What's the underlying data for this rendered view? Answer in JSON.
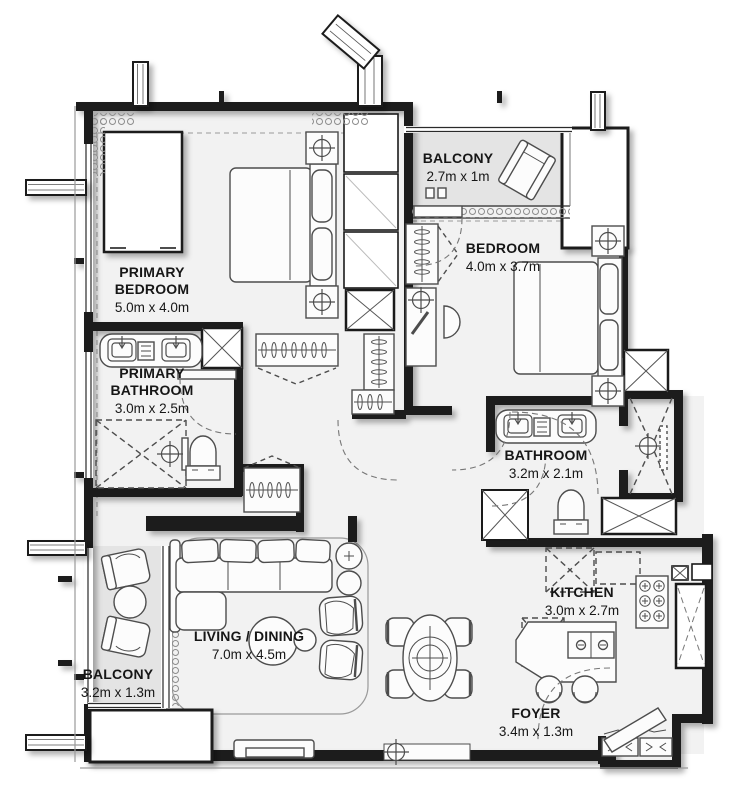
{
  "plan": {
    "type": "apartment-floor-plan",
    "colors": {
      "wall": "#1a1a1a",
      "floor": "#f2f2f2",
      "balcony_floor": "#e4e4e4",
      "furniture_line": "#4d4d4d",
      "text": "#161616",
      "white": "#ffffff"
    },
    "rooms": [
      {
        "id": "primary-bedroom",
        "name": "PRIMARY BEDROOM",
        "dims": "5.0m x 4.0m"
      },
      {
        "id": "balcony-top",
        "name": "BALCONY",
        "dims": "2.7m x 1m"
      },
      {
        "id": "bedroom",
        "name": "BEDROOM",
        "dims": "4.0m x 3.7m"
      },
      {
        "id": "primary-bathroom",
        "name": "PRIMARY BATHROOM",
        "dims": "3.0m x 2.5m"
      },
      {
        "id": "bathroom",
        "name": "BATHROOM",
        "dims": "3.2m x 2.1m"
      },
      {
        "id": "kitchen",
        "name": "KITCHEN",
        "dims": "3.0m x 2.7m"
      },
      {
        "id": "living-dining",
        "name": "LIVING / DINING",
        "dims": "7.0m x 4.5m"
      },
      {
        "id": "foyer",
        "name": "FOYER",
        "dims": "3.4m x 1.3m"
      },
      {
        "id": "balcony-bottom",
        "name": "BALCONY",
        "dims": "3.2m x 1.3m"
      }
    ]
  }
}
